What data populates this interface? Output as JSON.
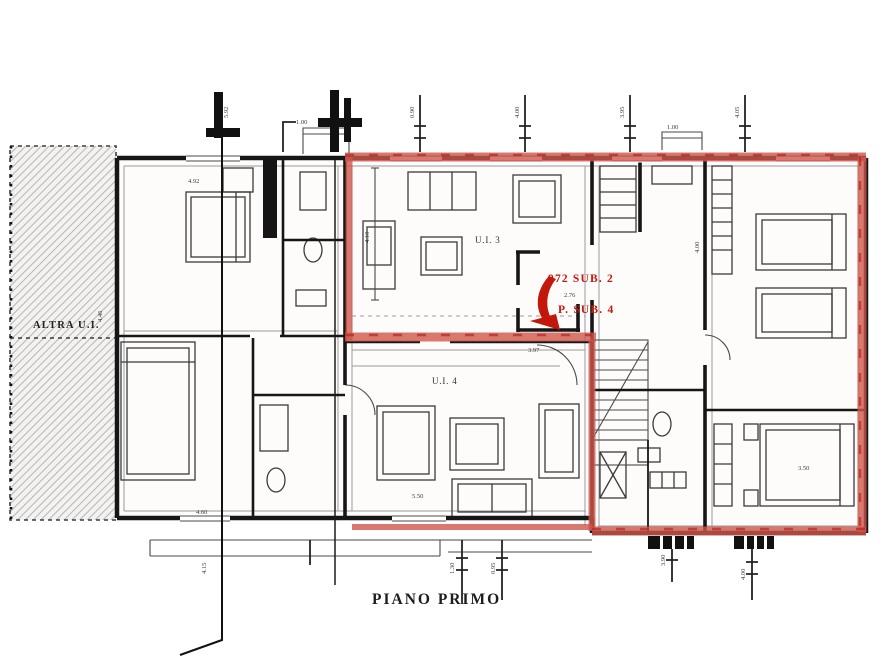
{
  "page": {
    "width": 893,
    "height": 670,
    "background": "#ffffff"
  },
  "colors": {
    "paper": "#ffffff",
    "wall": "#161616",
    "red": "#d0564c",
    "red_dark": "#b3271c",
    "red_text": "#c4170b",
    "hatch_line": "#b5b5b5",
    "hatch_bg": "#f3f2f0"
  },
  "labels": {
    "floor_title": "PIANO PRIMO",
    "adjacent_unit": "ALTRA U.I.",
    "unit_3": "U.I. 3",
    "unit_4": "U.I. 4",
    "cadastral_line_1": "972 SUB. 2",
    "cadastral_line_2": "P. SUB. 4"
  },
  "dimensions": [
    {
      "v": "1.00",
      "x": 296,
      "y": 124,
      "r": 0
    },
    {
      "v": "1.00",
      "x": 667,
      "y": 129,
      "r": 0
    },
    {
      "v": "5.92",
      "x": 228,
      "y": 118,
      "r": -90
    },
    {
      "v": "0.90",
      "x": 414,
      "y": 118,
      "r": -90
    },
    {
      "v": "4.00",
      "x": 519,
      "y": 118,
      "r": -90
    },
    {
      "v": "3.95",
      "x": 624,
      "y": 118,
      "r": -90
    },
    {
      "v": "4.05",
      "x": 739,
      "y": 118,
      "r": -90
    },
    {
      "v": "4.92",
      "x": 188,
      "y": 183,
      "r": 0
    },
    {
      "v": "4.46",
      "x": 102,
      "y": 322,
      "r": -90
    },
    {
      "v": "4.10",
      "x": 369,
      "y": 243,
      "r": -90
    },
    {
      "v": "4.00",
      "x": 699,
      "y": 253,
      "r": -90
    },
    {
      "v": "2.76",
      "x": 564,
      "y": 297,
      "r": 0
    },
    {
      "v": "3.97",
      "x": 528,
      "y": 352,
      "r": 0
    },
    {
      "v": "4.60",
      "x": 196,
      "y": 514,
      "r": 0
    },
    {
      "v": "5.50",
      "x": 412,
      "y": 498,
      "r": 0
    },
    {
      "v": "3.50",
      "x": 798,
      "y": 470,
      "r": 0
    },
    {
      "v": "4.15",
      "x": 206,
      "y": 574,
      "r": -90
    },
    {
      "v": "1.30",
      "x": 454,
      "y": 574,
      "r": -90
    },
    {
      "v": "0.95",
      "x": 495,
      "y": 574,
      "r": -90
    },
    {
      "v": "3.90",
      "x": 665,
      "y": 566,
      "r": -90
    },
    {
      "v": "4.00",
      "x": 745,
      "y": 580,
      "r": -90
    }
  ]
}
